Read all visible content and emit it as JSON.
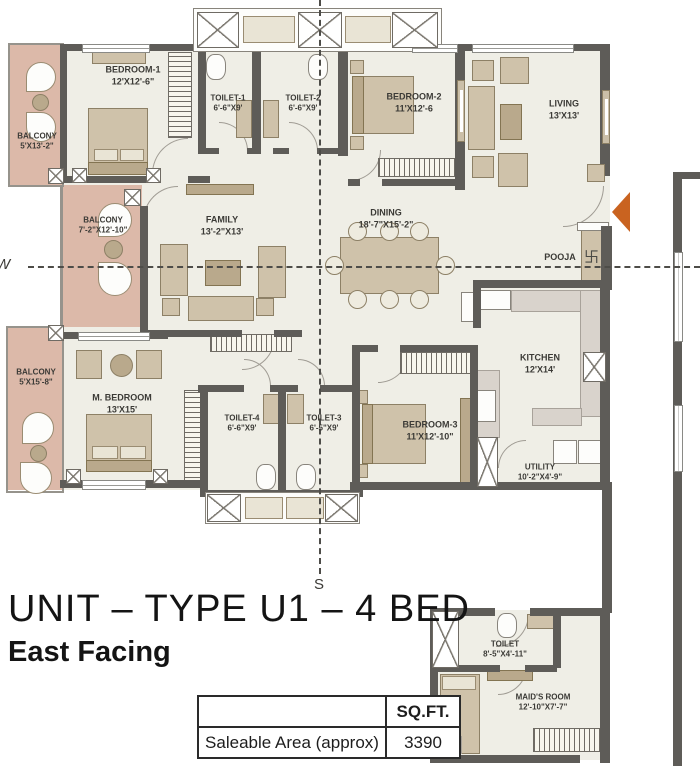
{
  "plan": {
    "rooms": [
      {
        "name": "BEDROOM-1",
        "dims": "12'X12'-6\""
      },
      {
        "name": "TOILET-1",
        "dims": "6'-6\"X9'"
      },
      {
        "name": "TOILET-2",
        "dims": "6'-6\"X9'"
      },
      {
        "name": "BEDROOM-2",
        "dims": "11'X12'-6"
      },
      {
        "name": "LIVING",
        "dims": "13'X13'"
      },
      {
        "name": "BALCONY",
        "dims": "5'X13'-2\""
      },
      {
        "name": "BALCONY",
        "dims": "7'-2\"X12'-10\""
      },
      {
        "name": "FAMILY",
        "dims": "13'-2\"X13'"
      },
      {
        "name": "DINING",
        "dims": "18'-7\"X15'-2\""
      },
      {
        "name": "POOJA",
        "dims": ""
      },
      {
        "name": "BALCONY",
        "dims": "5'X15'-8\""
      },
      {
        "name": "M. BEDROOM",
        "dims": "13'X15'"
      },
      {
        "name": "TOILET-4",
        "dims": "6'-6\"X9'"
      },
      {
        "name": "TOILET-3",
        "dims": "6'-5\"X9'"
      },
      {
        "name": "BEDROOM-3",
        "dims": "11'X12'-10\""
      },
      {
        "name": "KITCHEN",
        "dims": "12'X14'"
      },
      {
        "name": "UTILITY",
        "dims": "10'-2\"X4'-9\""
      },
      {
        "name": "TOILET",
        "dims": "8'-5\"X4'-11\""
      },
      {
        "name": "MAID'S ROOM",
        "dims": "12'-10\"X7'-7\""
      }
    ],
    "compass": {
      "south": "S",
      "west": "W"
    },
    "pooja_symbol": "卐"
  },
  "caption": {
    "title": "UNIT – TYPE U1 – 4 BED",
    "subtitle": "East Facing"
  },
  "area_table": {
    "header": "SQ.FT.",
    "row_label": "Saleable Area (approx)",
    "value": "3390"
  },
  "colors": {
    "wall": "#5e5c58",
    "floor": "#efeee6",
    "balcony": "#dcb9a9",
    "fur": "#cfc2aa",
    "accent": "#c96320"
  }
}
